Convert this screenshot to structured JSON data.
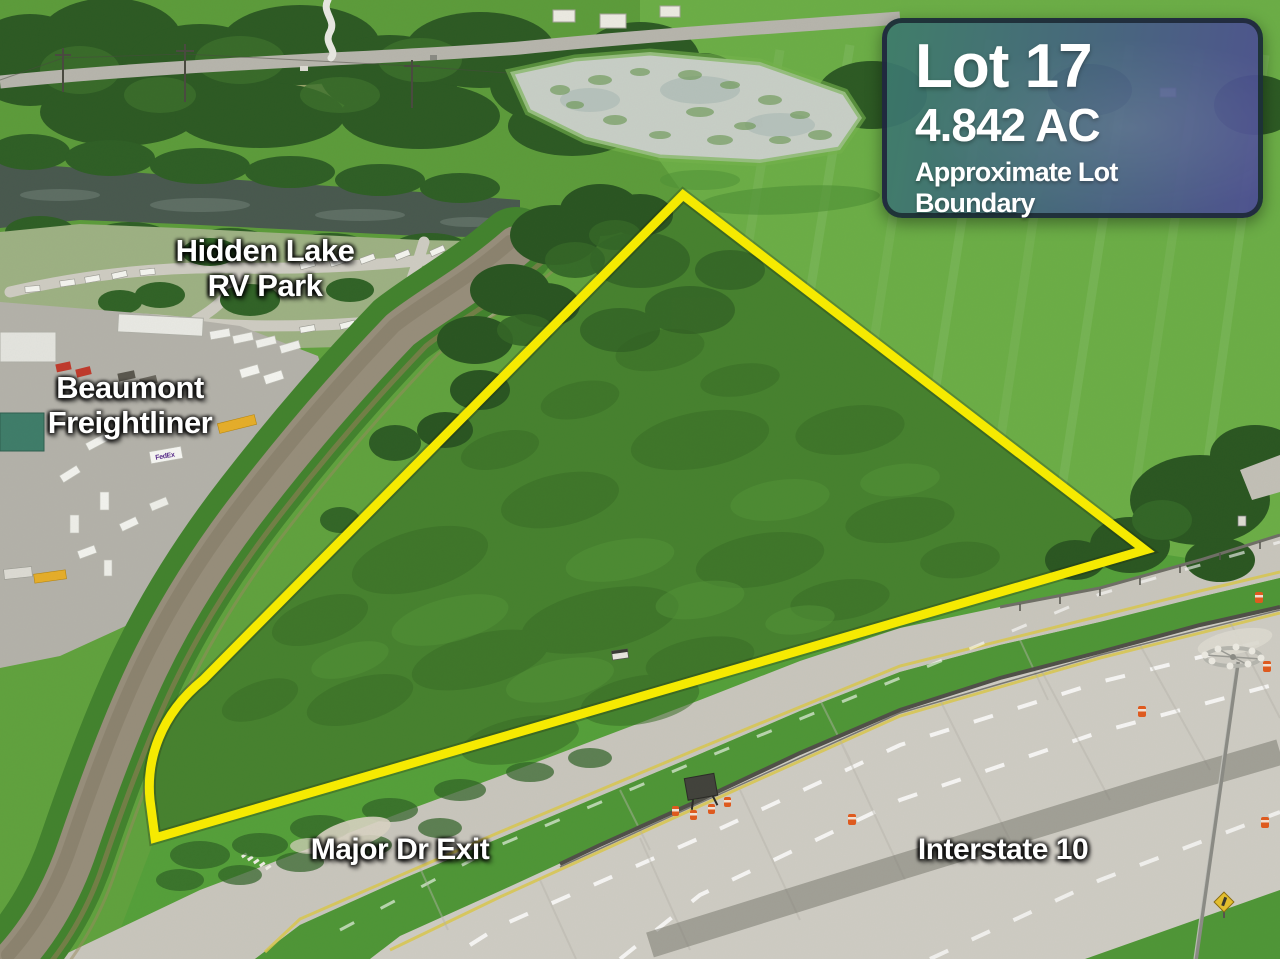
{
  "scene": {
    "description": "Aerial drone photograph of a vacant triangular land parcel outlined in yellow beside Interstate 10"
  },
  "info_card": {
    "title": "Lot 17",
    "acreage": "4.842 AC",
    "subtitle": "Approximate Lot Boundary",
    "bg_start": "#3c7a6c",
    "bg_end": "#4c4b95",
    "text_color": "#ffffff"
  },
  "labels": {
    "rv_park_line1": "Hidden Lake",
    "rv_park_line2": "RV Park",
    "freightliner_line1": "Beaumont",
    "freightliner_line2": "Freightliner",
    "exit": "Major Dr Exit",
    "interstate": "Interstate 10",
    "fedex_truck": "FedEx"
  },
  "colors": {
    "lot_boundary": "#f8ec00",
    "field_green": "#6cae47",
    "upper_left_field": "#5d9c3b",
    "lot_green": "#47822f",
    "water_river": "#49594f",
    "canal_water": "#978e7b",
    "highway_concrete": "#cfccc4",
    "ramp_concrete": "#c9c6bd",
    "median_grass": "#4f9637",
    "traffic_barrel": "#e05a1e",
    "label_text": "#ffffff"
  }
}
